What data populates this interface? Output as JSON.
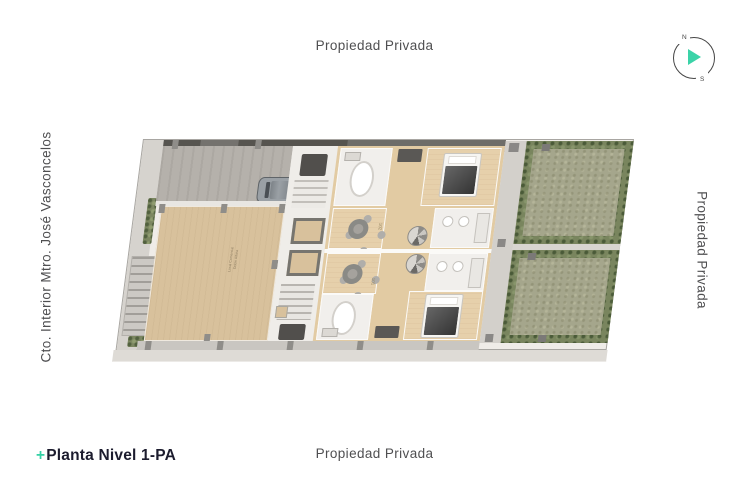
{
  "labels": {
    "top": "Propiedad Privada",
    "bottom": "Propiedad Privada",
    "right_side": "Propiedad Privada",
    "left_side": "Cto. Interior Mtro. José Vasconcelos"
  },
  "title": {
    "prefix": "+",
    "text": "Planta Nivel 1-PA"
  },
  "compass": {
    "north_label": "N",
    "south_label": "S",
    "needle_color": "#3bd3a8"
  },
  "plan": {
    "unit_label_top": "102",
    "unit_label_bottom": "101",
    "terrace_note_line1": "Local Comercial",
    "terrace_note_line2": "Doble Altura"
  },
  "colors": {
    "accent_teal": "#35d1a6",
    "label_gray": "#4f4f51",
    "title_dark": "#1c1c2e",
    "terrace_tan": "#d8c19c",
    "wood_floor": "#e2cba3",
    "grass_green": "#a5a68c",
    "hedge_green": "#79855e",
    "driveway_gray": "#b5b1ab",
    "sidewalk_gray": "#d6d3ce",
    "wall_dark": "#56544f"
  }
}
